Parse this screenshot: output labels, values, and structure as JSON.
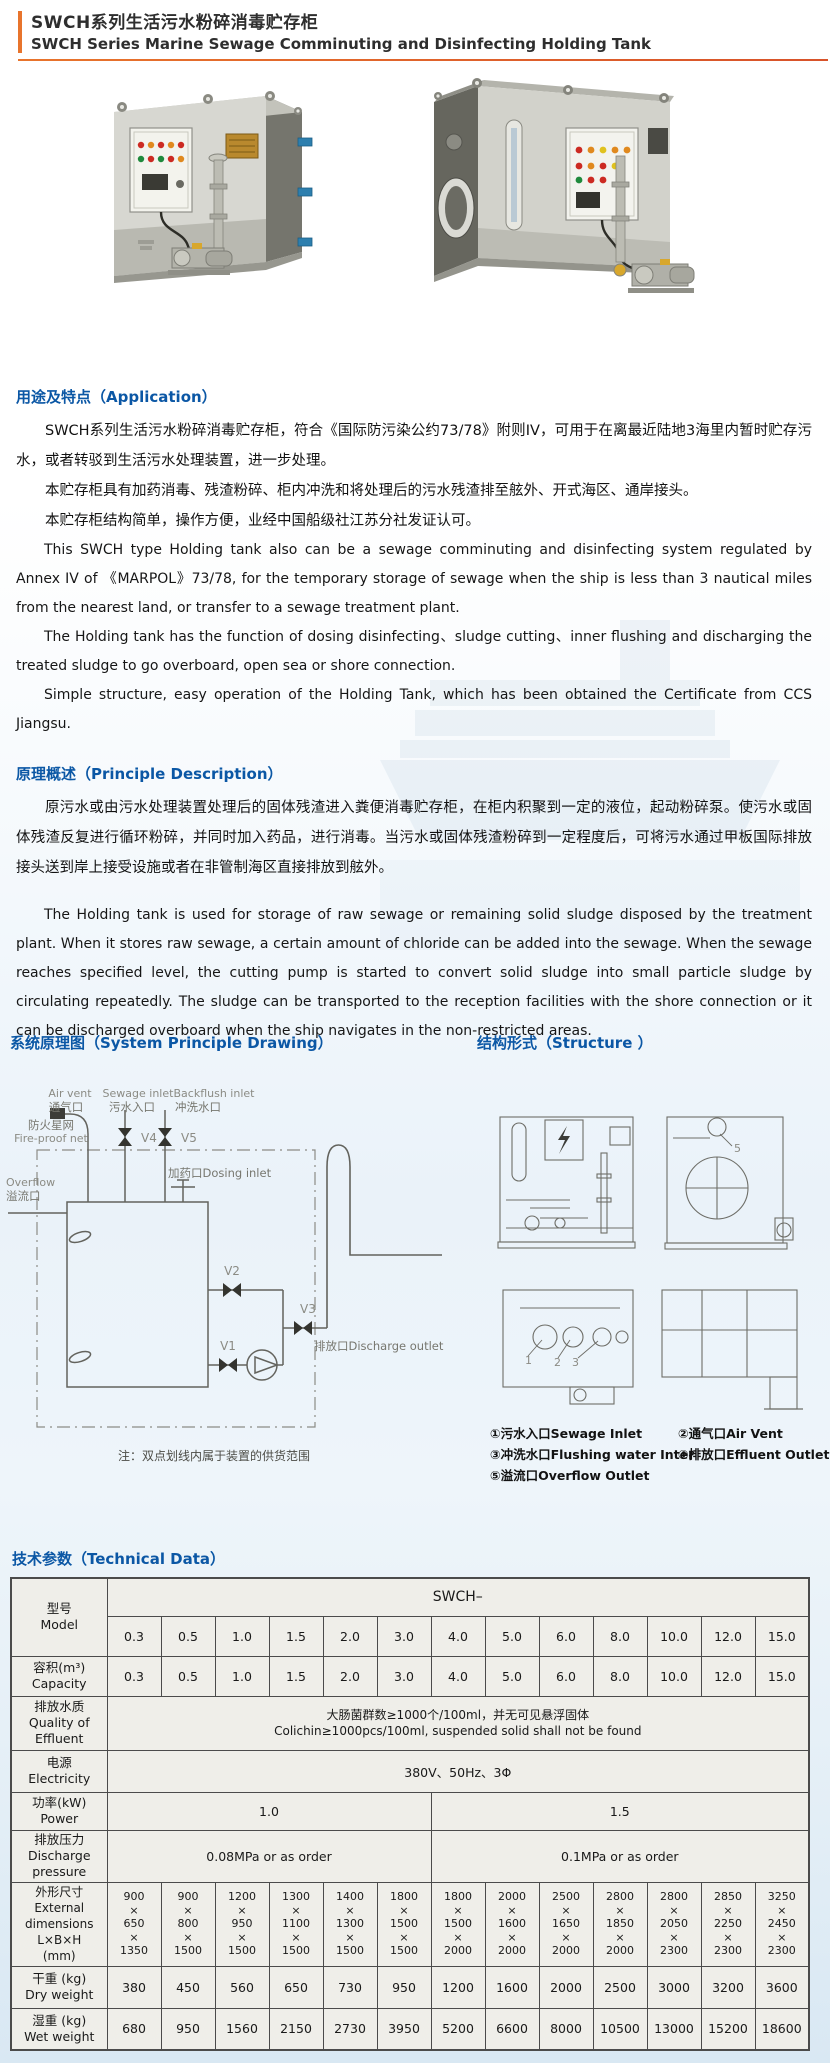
{
  "page": {
    "title_zh": "SWCH系列生活污水粉碎消毒贮存柜",
    "title_en": "SWCH Series Marine Sewage Comminuting and Disinfecting Holding Tank"
  },
  "colors": {
    "heading_blue": "#0b57a5",
    "accent_orange": "#e8742c",
    "table_line": "#4b4b4b"
  },
  "application": {
    "heading": "用途及特点（Application）",
    "paragraphs_zh": [
      "SWCH系列生活污水粉碎消毒贮存柜，符合《国际防污染公约73/78》附则IV，可用于在离最近陆地3海里内暂时贮存污水，或者转驳到生活污水处理装置，进一步处理。",
      "本贮存柜具有加药消毒、残渣粉碎、柜内冲洗和将处理后的污水残渣排至舷外、开式海区、通岸接头。",
      "本贮存柜结构简单，操作方便，业经中国船级社江苏分社发证认可。"
    ],
    "paragraphs_en": [
      "This SWCH type Holding tank also can be a sewage comminuting and disinfecting system regulated by Annex IV of 《MARPOL》73/78, for the temporary storage of sewage when the ship is less than 3 nautical miles from the nearest land, or transfer to a sewage treatment plant.",
      "The Holding tank has the function of dosing disinfecting、sludge cutting、inner flushing and discharging the treated sludge to go overboard, open sea or shore connection.",
      "Simple structure, easy operation of the Holding Tank, which has been obtained the Certificate from CCS Jiangsu."
    ]
  },
  "principle": {
    "heading": "原理概述（Principle Description）",
    "paragraph_zh": "原污水或由污水处理装置处理后的固体残渣进入粪便消毒贮存柜，在柜内积聚到一定的液位，起动粉碎泵。使污水或固体残渣反复进行循环粉碎，并同时加入药品，进行消毒。当污水或固体残渣粉碎到一定程度后，可将污水通过甲板国际排放接头送到岸上接受设施或者在非管制海区直接排放到舷外。",
    "paragraph_en": "The Holding tank is used for storage of raw sewage or remaining solid sludge disposed by the treatment plant. When it stores raw sewage, a certain amount of chloride can be added into the sewage. When the sewage reaches specified level, the cutting pump is started to convert solid sludge into small particle sludge by circulating repeatedly. The sludge can be transported to the reception facilities with the shore connection or it can be discharged overboard when the ship navigates in the non-restricted areas."
  },
  "system_drawing": {
    "heading": "系统原理图（System Principle Drawing）",
    "labels": {
      "air_vent_en": "Air vent",
      "air_vent_zh": "通气口",
      "sewage_inlet_en": "Sewage inlet",
      "sewage_inlet_zh": "污水入口",
      "backflush_inlet_en": "Backflush inlet",
      "backflush_inlet_zh": "冲洗水口",
      "fireproof_zh": "防火星网",
      "fireproof_en": "Fire-proof net",
      "overflow_en": "Overflow",
      "overflow_zh": "溢流口",
      "dosing_inlet": "加药口Dosing inlet",
      "discharge_outlet": "排放口Discharge outlet",
      "v1": "V1",
      "v2": "V2",
      "v3": "V3",
      "v4": "V4",
      "v5": "V5",
      "note": "注：双点划线内属于装置的供货范围"
    }
  },
  "structure": {
    "heading": "结构形式（Structure ）",
    "figure_labels": [
      "1",
      "2",
      "3",
      "5"
    ],
    "legend": [
      "①污水入口Sewage Inlet",
      "②通气口Air Vent",
      "③冲洗水口Flushing water Inter",
      "④排放口Effluent Outlet",
      "⑤溢流口Overflow Outlet"
    ]
  },
  "technical": {
    "heading": "技术参数（Technical Data）",
    "table": {
      "series_header": "SWCH–",
      "row_labels": {
        "model": [
          "型号",
          "Model"
        ],
        "capacity": [
          "容积(m³)",
          "Capacity"
        ],
        "effluent": [
          "排放水质",
          "Quality of",
          "Effluent"
        ],
        "electricity": [
          "电源",
          "Electricity"
        ],
        "power": [
          "功率(kW)",
          "Power"
        ],
        "pressure": [
          "排放压力",
          "Discharge",
          "pressure"
        ],
        "dimensions": [
          "外形尺寸",
          "External",
          "dimensions",
          "L×B×H",
          "(mm)"
        ],
        "dry": [
          "干重 (kg)",
          "Dry weight"
        ],
        "wet": [
          "湿重 (kg)",
          "Wet weight"
        ]
      },
      "models": [
        "0.3",
        "0.5",
        "1.0",
        "1.5",
        "2.0",
        "3.0",
        "4.0",
        "5.0",
        "6.0",
        "8.0",
        "10.0",
        "12.0",
        "15.0"
      ],
      "capacity": [
        "0.3",
        "0.5",
        "1.0",
        "1.5",
        "2.0",
        "3.0",
        "4.0",
        "5.0",
        "6.0",
        "8.0",
        "10.0",
        "12.0",
        "15.0"
      ],
      "effluent_zh": "大肠菌群数≥1000个/100ml，并无可见悬浮固体",
      "effluent_en": "Colichin≥1000pcs/100ml, suspended solid shall not be found",
      "electricity": "380V、50Hz、3Φ",
      "power": [
        {
          "span": 6,
          "value": "1.0"
        },
        {
          "span": 7,
          "value": "1.5"
        }
      ],
      "pressure": [
        {
          "span": 6,
          "value": "0.08MPa or as order"
        },
        {
          "span": 7,
          "value": "0.1MPa or as order"
        }
      ],
      "dimensions": [
        [
          "900",
          "650",
          "1350"
        ],
        [
          "900",
          "800",
          "1500"
        ],
        [
          "1200",
          "950",
          "1500"
        ],
        [
          "1300",
          "1100",
          "1500"
        ],
        [
          "1400",
          "1300",
          "1500"
        ],
        [
          "1800",
          "1500",
          "1500"
        ],
        [
          "1800",
          "1500",
          "2000"
        ],
        [
          "2000",
          "1600",
          "2000"
        ],
        [
          "2500",
          "1650",
          "2000"
        ],
        [
          "2800",
          "1850",
          "2000"
        ],
        [
          "2800",
          "2050",
          "2300"
        ],
        [
          "2850",
          "2250",
          "2300"
        ],
        [
          "3250",
          "2450",
          "2300"
        ]
      ],
      "dry_weight": [
        "380",
        "450",
        "560",
        "650",
        "730",
        "950",
        "1200",
        "1600",
        "2000",
        "2500",
        "3000",
        "3200",
        "3600"
      ],
      "wet_weight": [
        "680",
        "950",
        "1560",
        "2150",
        "2730",
        "3950",
        "5200",
        "6600",
        "8000",
        "10500",
        "13000",
        "15200",
        "18600"
      ]
    }
  }
}
